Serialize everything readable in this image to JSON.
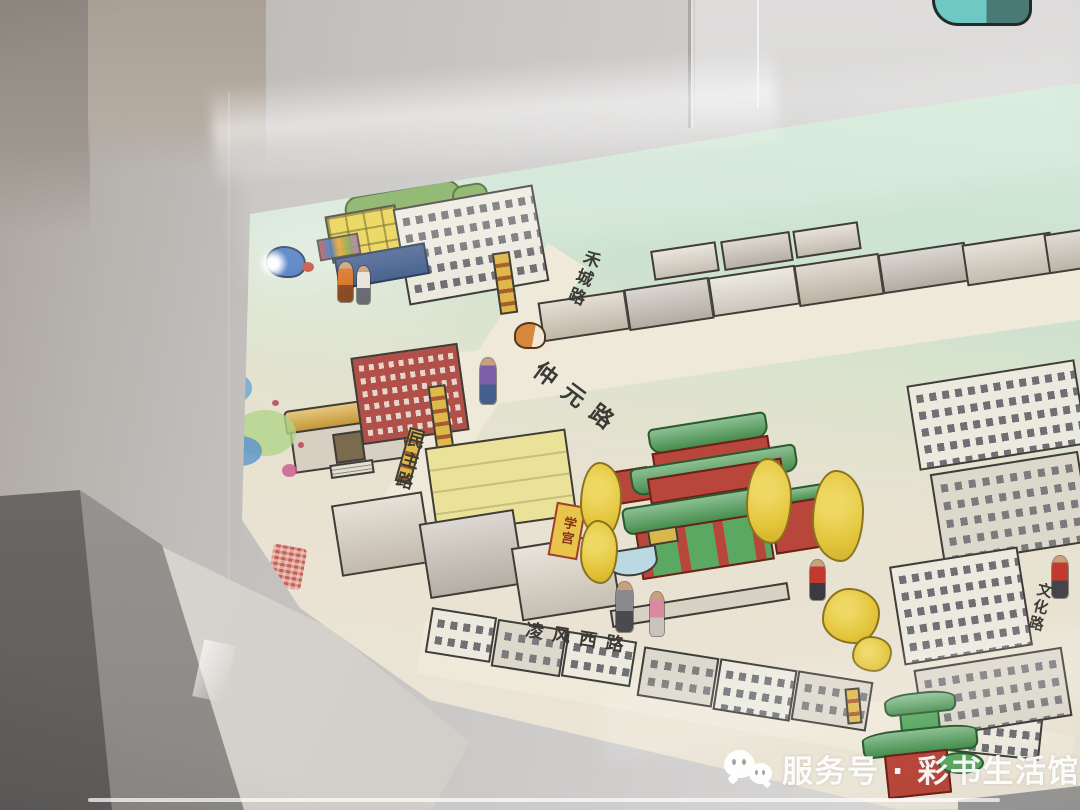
{
  "watermark": {
    "icon": "wechat-icon",
    "text": "服务号 · 彩书生活馆"
  },
  "artwork": {
    "street_labels": [
      {
        "name": "hecheng-road",
        "text": "禾城路",
        "orientation": "vertical"
      },
      {
        "name": "zhongyuan-road",
        "text": "仲元路",
        "orientation": "diagonal"
      },
      {
        "name": "minzhu-road",
        "text": "民主路",
        "orientation": "vertical"
      },
      {
        "name": "lingfeng-west-road",
        "text": "凌风西路",
        "orientation": "diagonal"
      },
      {
        "name": "wenhua-road",
        "text": "文化路",
        "orientation": "vertical"
      }
    ],
    "plaques": [
      {
        "name": "xuegong-plaque",
        "text": "学宫"
      }
    ],
    "colors": {
      "mint_background": "#cfe5d4",
      "paper": "#e9e2d1",
      "temple_green": "#4f9e58",
      "temple_red": "#b8463a",
      "ginkgo_yellow": "#e4c63c",
      "sign_yellow": "#dfb84a",
      "seal_red": "#c0544a",
      "ink_outline": "#3f3d38"
    }
  },
  "environment": {
    "wall_gray": "#c8c6c4",
    "floor_dark": "#6f6c6a",
    "watermark_white": "#ffffff"
  }
}
